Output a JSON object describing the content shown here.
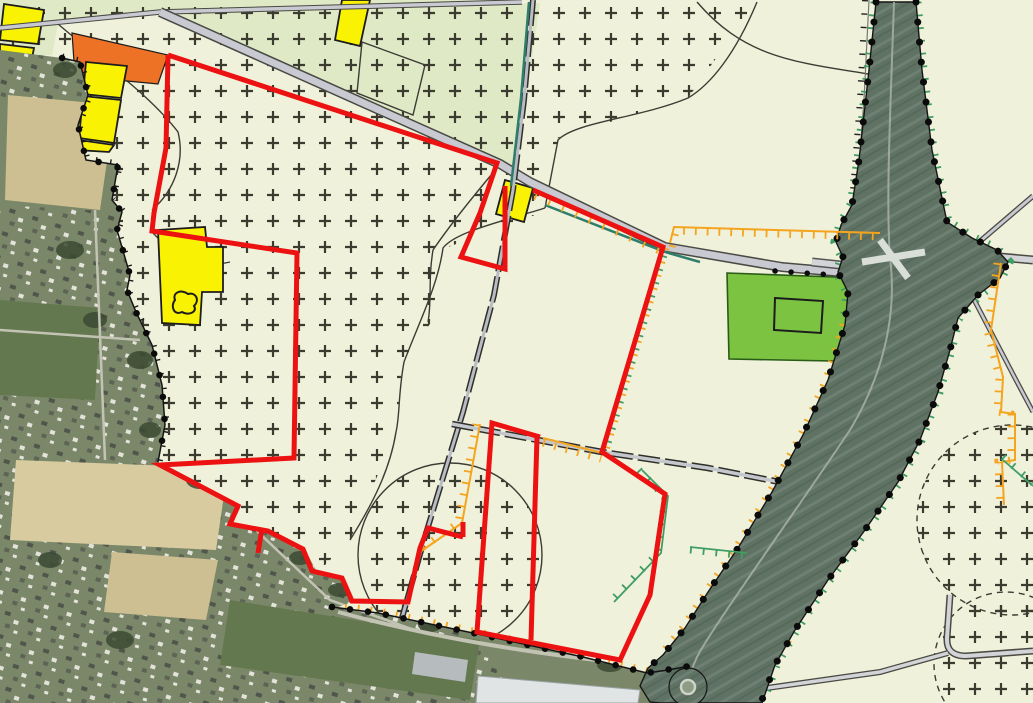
{
  "map": {
    "description": "zoning-plan-map-over-aerial-photo",
    "colors": {
      "cream_bg": "#f0f1da",
      "light_green_area": "#dfe9c6",
      "plus_symbol": "#3b3b30",
      "plan_boundary_red": "#ec1212",
      "residential_yellow": "#f9f303",
      "parcel_outline_black": "#1c1c1c",
      "orange_parcel": "#ee7225",
      "green_parcel": "#7cc342",
      "green_parcel_outline": "#295c17",
      "road_fill": "#c9c9d2",
      "road_fill_light": "#d2d4d8",
      "road_edge": "#4b4b44",
      "road_edge_dark": "#2f2f2a",
      "teal_line": "#2f7d6b",
      "orange_hatch": "#f4a41e",
      "green_hatch": "#3f9e63",
      "boundary_black": "#141414",
      "thin_line": "#3c3c34",
      "fence_gray": "#787872",
      "aerial_base": "#7b8769",
      "aerial_field_tan": "#cdbf92",
      "aerial_field_tan2": "#d8cba0",
      "aerial_field_green": "#64784f",
      "aerial_tree_dark": "#3b4a33",
      "aerial_street": "#c3c3b4",
      "highway_fill": "#5f7264",
      "highway_stripe_light": "#6d8071",
      "highway_stripe_dark": "#566a5a",
      "highway_centerline": "#a8b1a3",
      "junction_cross": "#d9ded6",
      "roundabout_inner": "#8f9c85",
      "roundabout_ring": "#cdd3c6",
      "building_white": "#e0e4e5",
      "building_gray": "#b6bcbd",
      "house_dark": "#50564b",
      "house_light": "#e3e3da"
    }
  }
}
